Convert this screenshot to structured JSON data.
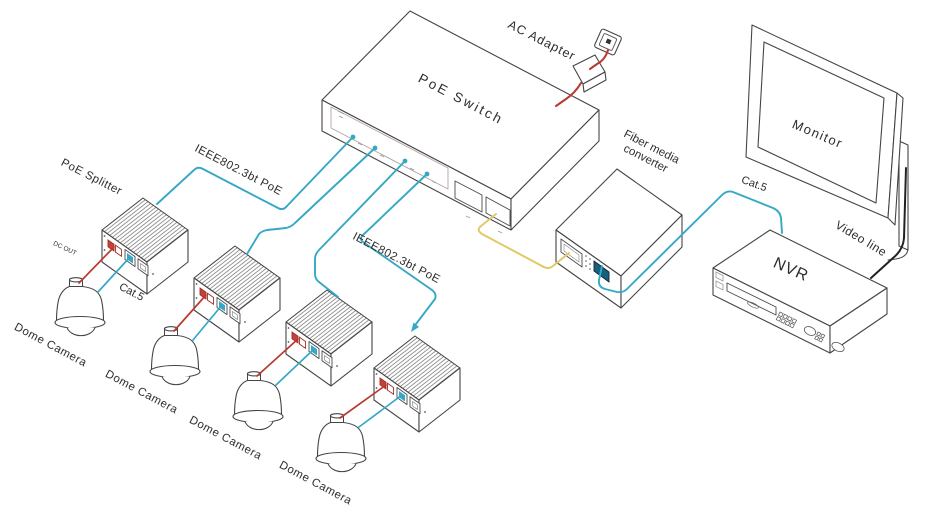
{
  "colors": {
    "cable": "#35a8c5",
    "power": "#b93a33",
    "fiber": "#e2c968",
    "video": "#222222",
    "outline": "#454545"
  },
  "labels": {
    "ac_adapter": "AC Adapter",
    "poe_switch": "PoE Switch",
    "poe_standard_1": "IEEE802.3bt PoE",
    "poe_standard_2": "IEEE802.3bt PoE",
    "poe_splitter": "PoE Splitter",
    "dc_out": "DC OUT",
    "cat5_camera": "Cat.5",
    "cat5_nvr": "Cat.5",
    "fiber_converter_line1": "Fiber media",
    "fiber_converter_line2": "converter",
    "monitor": "Monitor",
    "video_line": "Video line",
    "nvr": "NVR",
    "dome_camera_1": "Dome Camera",
    "dome_camera_2": "Dome Camera",
    "dome_camera_3": "Dome Camera",
    "dome_camera_4": "Dome Camera"
  },
  "devices": [
    "AC power outlet",
    "AC Adapter",
    "PoE Switch",
    "PoE Splitter",
    "PoE Splitter",
    "PoE Splitter",
    "PoE Splitter",
    "Dome Camera",
    "Dome Camera",
    "Dome Camera",
    "Dome Camera",
    "Fiber media converter",
    "NVR",
    "Monitor"
  ],
  "connections": [
    {
      "from": "wall-outlet",
      "to": "poe-switch",
      "via": "AC Adapter",
      "cable": "power"
    },
    {
      "from": "poe-switch",
      "to": "poe-splitter-1",
      "cable": "IEEE802.3bt PoE"
    },
    {
      "from": "poe-switch",
      "to": "poe-splitter-2",
      "cable": "IEEE802.3bt PoE"
    },
    {
      "from": "poe-switch",
      "to": "poe-splitter-3",
      "cable": "IEEE802.3bt PoE"
    },
    {
      "from": "poe-switch",
      "to": "poe-splitter-4",
      "cable": "IEEE802.3bt PoE"
    },
    {
      "from": "poe-splitter-1",
      "to": "dome-camera-1",
      "cable": "DC OUT + Cat.5"
    },
    {
      "from": "poe-splitter-2",
      "to": "dome-camera-2",
      "cable": "DC OUT + Cat.5"
    },
    {
      "from": "poe-splitter-3",
      "to": "dome-camera-3",
      "cable": "DC OUT + Cat.5"
    },
    {
      "from": "poe-splitter-4",
      "to": "dome-camera-4",
      "cable": "DC OUT + Cat.5"
    },
    {
      "from": "poe-switch",
      "to": "fiber-media-converter",
      "cable": "fiber"
    },
    {
      "from": "fiber-media-converter",
      "to": "nvr",
      "cable": "Cat.5"
    },
    {
      "from": "nvr",
      "to": "monitor",
      "cable": "Video line"
    }
  ]
}
